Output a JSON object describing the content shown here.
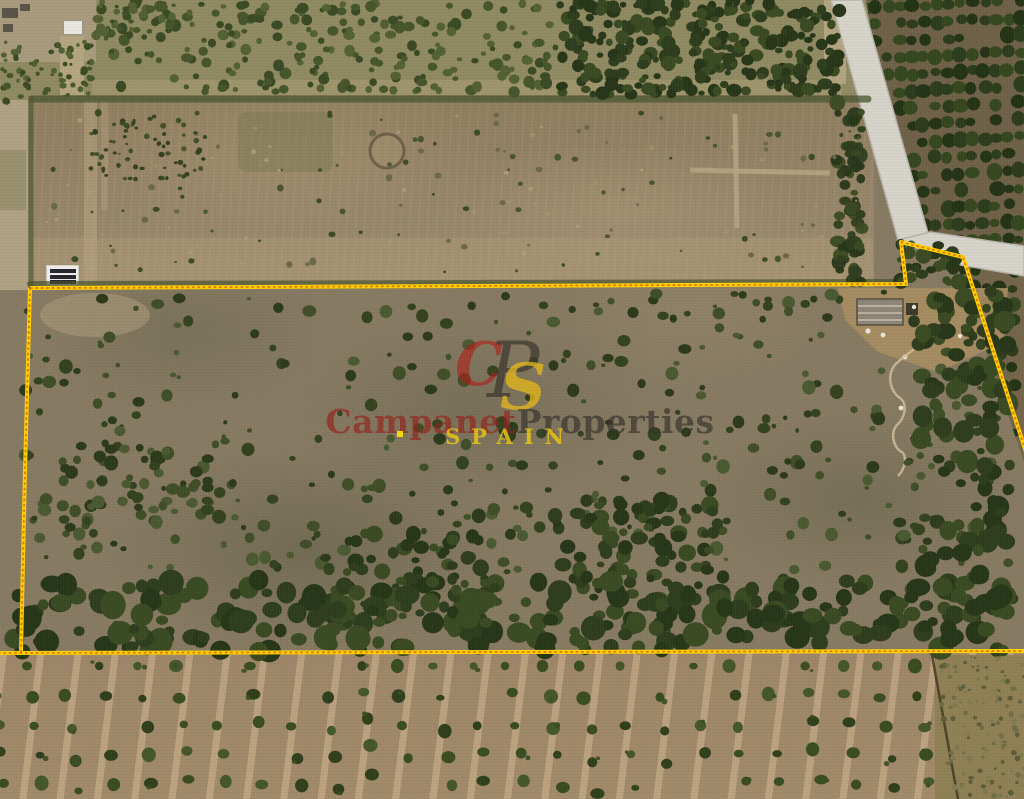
{
  "scene": {
    "kind": "aerial satellite view of rural land plots with a highlighted property boundary",
    "boundary": {
      "line_color": "#ffd400",
      "dash_color": "#e67300"
    }
  },
  "watermark": {
    "monogram": {
      "c": "C",
      "p": "P",
      "s": "S"
    },
    "brand": {
      "word1": "Campanet",
      "word2": "Properties"
    },
    "country": "SPAIN",
    "colors": {
      "monogram_c": "#b01f1a",
      "monogram_p": "#2e2a24",
      "monogram_s": "#e4b71a",
      "word1": "#96211a",
      "word2": "#35302b",
      "country": "#e8c614"
    }
  }
}
